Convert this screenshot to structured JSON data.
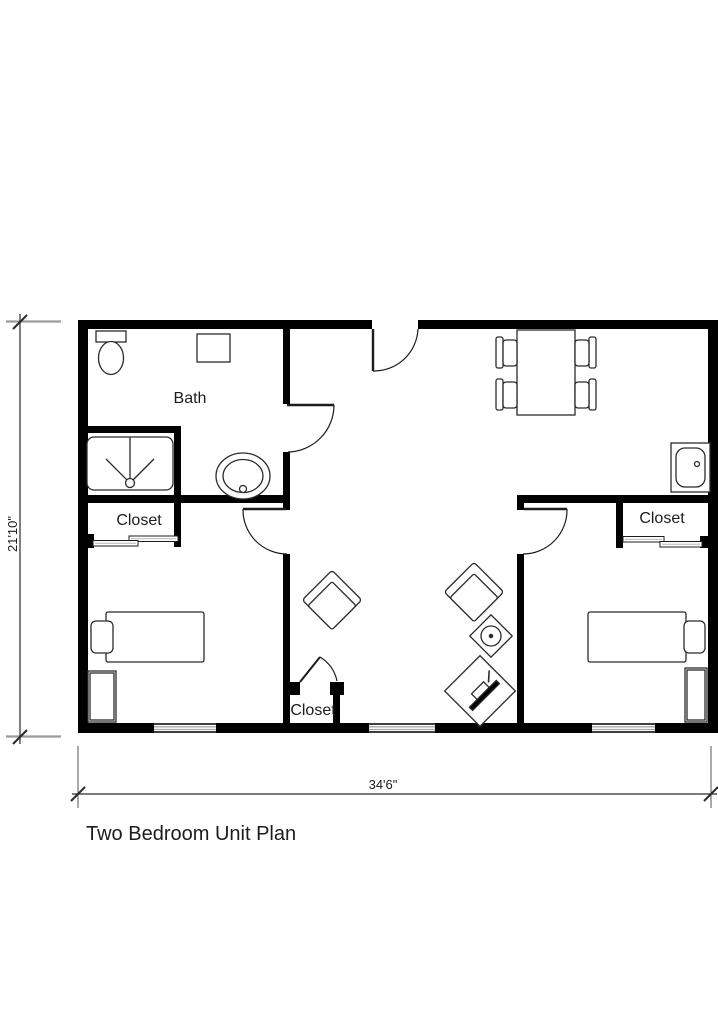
{
  "title": "Two Bedroom Unit Plan",
  "rooms": {
    "bath_label": "Bath",
    "closet_left_label": "Closet",
    "closet_center_label": "Closet",
    "closet_right_label": "Closet"
  },
  "dimensions": {
    "overall_width_label": "34'6\"",
    "overall_height_label": "21'10\""
  },
  "colors": {
    "wall": "#000000",
    "line": "#2b2b2b",
    "extension_line": "#999999",
    "background": "#ffffff"
  }
}
